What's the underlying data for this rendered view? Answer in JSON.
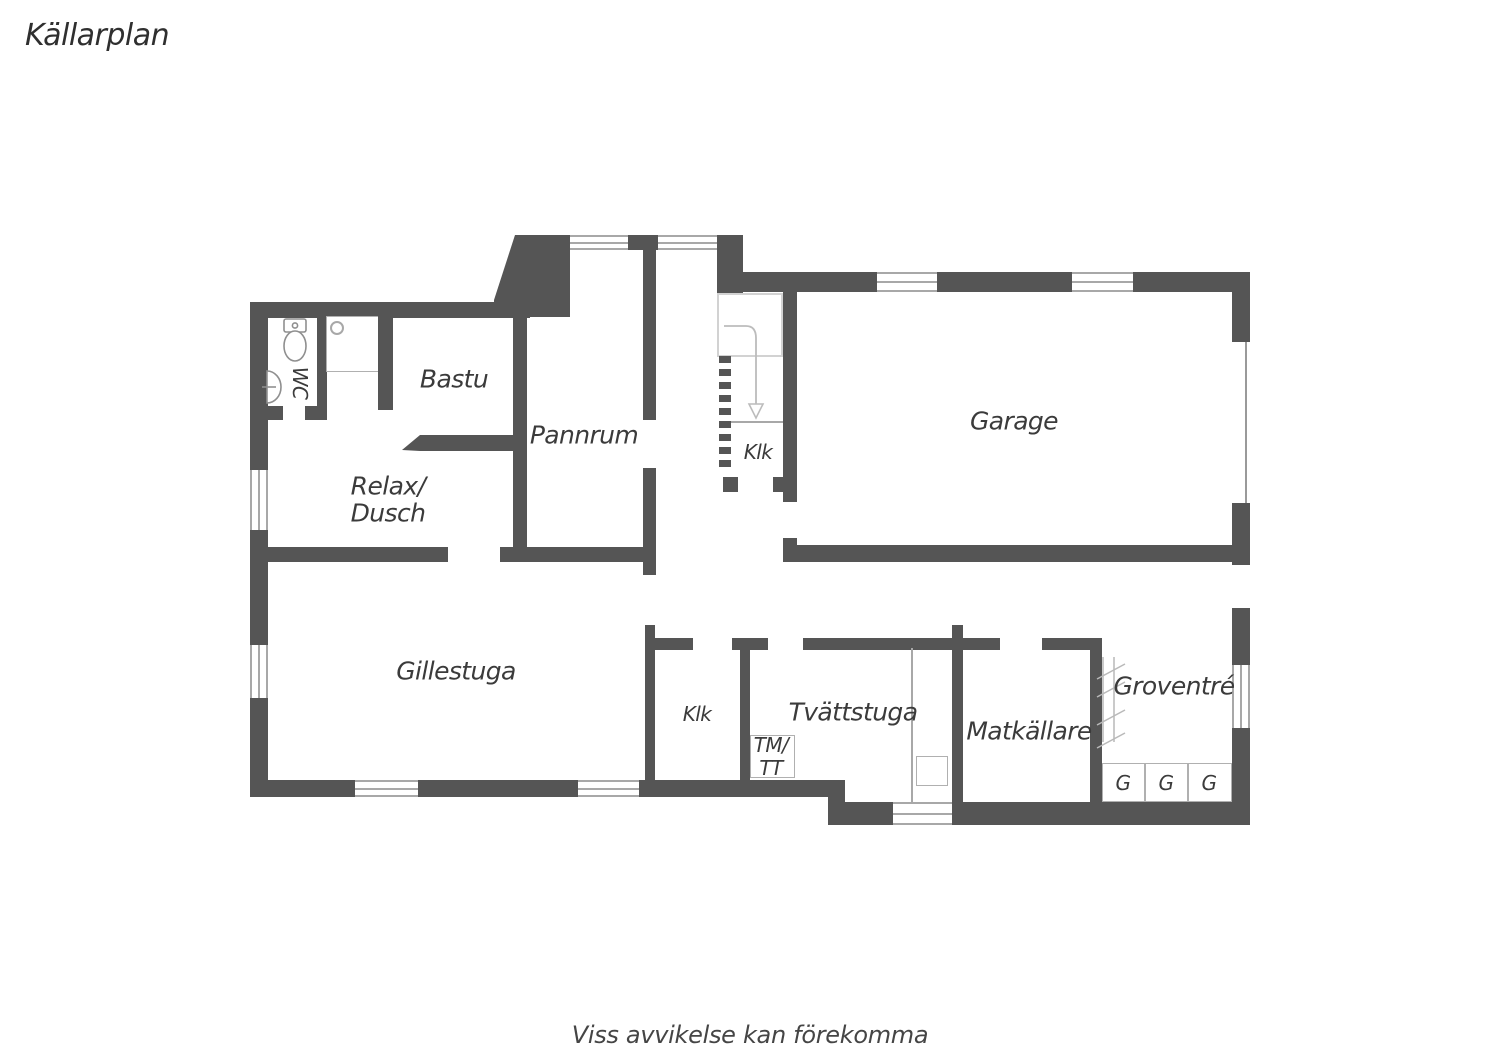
{
  "title": "Källarplan",
  "footer": "Viss avvikelse kan förekomma",
  "colors": {
    "wall": "#555555",
    "thin_line": "#a8a8a8",
    "faint_line": "#d2d2d2",
    "label_text": "#3b3b3b"
  },
  "rooms": {
    "wc": "WC",
    "bastu": "Bastu",
    "pannrum": "Pannrum",
    "klk_stairs": "Klk",
    "garage": "Garage",
    "relax_line1": "Relax/",
    "relax_line2": "Dusch",
    "gillestuga": "Gillestuga",
    "klk": "Klk",
    "tvattstuga": "Tvättstuga",
    "tm_line1": "TM/",
    "tm_line2": "TT",
    "matkallare": "Matkällare",
    "groventre": "Groventré",
    "wardrobe1": "G",
    "wardrobe2": "G",
    "wardrobe3": "G"
  }
}
